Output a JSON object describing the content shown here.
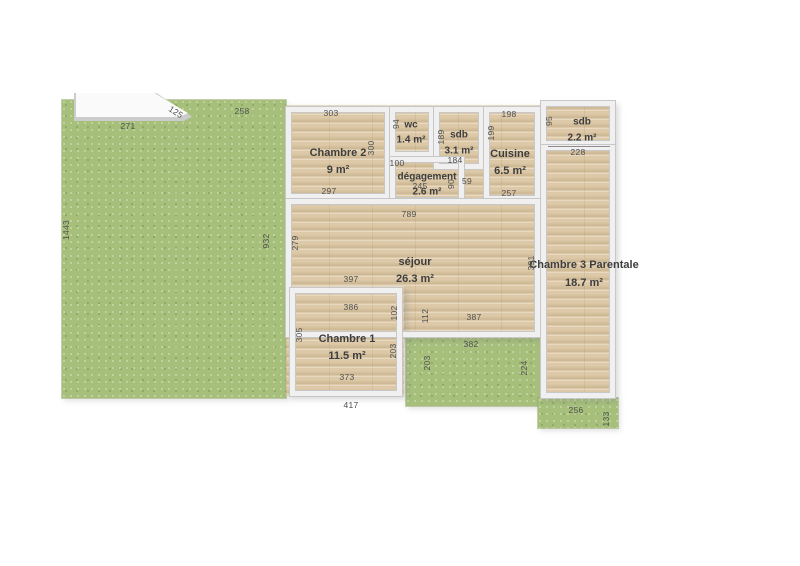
{
  "plan": {
    "colors": {
      "background": "#ffffff",
      "grass": "#a6c07c",
      "wood": "#ddc9a7",
      "wall": "#f0f0f0",
      "wall_edge": "#c7c7c7",
      "label_text": "#3d3d3d",
      "dimension_text": "#4f4f4f"
    },
    "rooms": [
      {
        "id": "chambre2",
        "name": "Chambre 2",
        "area": "9 m²",
        "box": [
          286,
          107,
          104,
          92
        ],
        "label": [
          338,
          153
        ],
        "fs": 11,
        "gap": 17
      },
      {
        "id": "wc",
        "name": "wc",
        "area": "1.4 m²",
        "box": [
          390,
          107,
          44,
          50
        ],
        "label": [
          411,
          125
        ],
        "fs": 10,
        "gap": 15
      },
      {
        "id": "sdb1",
        "name": "sdb",
        "area": "3.1 m²",
        "box": [
          434,
          107,
          50,
          62
        ],
        "label": [
          459,
          135
        ],
        "fs": 10,
        "gap": 16
      },
      {
        "id": "cuisine",
        "name": "Cuisine",
        "area": "6.5 m²",
        "box": [
          484,
          107,
          56,
          94
        ],
        "label": [
          510,
          154
        ],
        "fs": 11,
        "gap": 17
      },
      {
        "id": "degagement",
        "name": "dégagement",
        "area": "2.6 m²",
        "box": [
          390,
          157,
          74,
          46
        ],
        "label": [
          427,
          177
        ],
        "fs": 10,
        "gap": 15
      },
      {
        "id": "sdb2",
        "name": "sdb",
        "area": "2.2 m²",
        "box": [
          541,
          101,
          74,
          45
        ],
        "label": [
          582,
          122
        ],
        "fs": 10,
        "gap": 16
      },
      {
        "id": "sejour",
        "name": "séjour",
        "area": "26.3 m²",
        "box": [
          286,
          199,
          254,
          138
        ],
        "label": [
          415,
          262
        ],
        "fs": 11,
        "gap": 17
      },
      {
        "id": "chambre1",
        "name": "Chambre 1",
        "area": "11.5 m²",
        "box": [
          290,
          288,
          112,
          108
        ],
        "label": [
          347,
          339
        ],
        "fs": 11,
        "gap": 17
      },
      {
        "id": "chambre3",
        "name": "Chambre 3 Parentale",
        "area": "18.7 m²",
        "box": [
          541,
          145,
          74,
          253
        ],
        "label": [
          584,
          265
        ],
        "fs": 11,
        "gap": 18
      }
    ],
    "dimensions": [
      {
        "t": "271",
        "x": 128,
        "y": 126
      },
      {
        "t": "125",
        "x": 176,
        "y": 112,
        "o": 33
      },
      {
        "t": "258",
        "x": 242,
        "y": 111
      },
      {
        "t": "1443",
        "x": 66,
        "y": 230,
        "o": "v"
      },
      {
        "t": "932",
        "x": 266,
        "y": 241,
        "o": "v"
      },
      {
        "t": "303",
        "x": 331,
        "y": 113
      },
      {
        "t": "300",
        "x": 371,
        "y": 148,
        "o": "v"
      },
      {
        "t": "297",
        "x": 329,
        "y": 191
      },
      {
        "t": "94",
        "x": 396,
        "y": 124,
        "o": "v"
      },
      {
        "t": "189",
        "x": 441,
        "y": 137,
        "o": "v"
      },
      {
        "t": "184",
        "x": 455,
        "y": 160
      },
      {
        "t": "198",
        "x": 509,
        "y": 114
      },
      {
        "t": "199",
        "x": 491,
        "y": 133,
        "o": "v"
      },
      {
        "t": "257",
        "x": 509,
        "y": 193
      },
      {
        "t": "59",
        "x": 467,
        "y": 181
      },
      {
        "t": "100",
        "x": 397,
        "y": 163
      },
      {
        "t": "245",
        "x": 420,
        "y": 186
      },
      {
        "t": "90",
        "x": 451,
        "y": 184,
        "o": "v"
      },
      {
        "t": "95",
        "x": 549,
        "y": 121,
        "o": "v"
      },
      {
        "t": "228",
        "x": 578,
        "y": 152
      },
      {
        "t": "789",
        "x": 409,
        "y": 214
      },
      {
        "t": "279",
        "x": 295,
        "y": 243,
        "o": "v"
      },
      {
        "t": "397",
        "x": 351,
        "y": 279
      },
      {
        "t": "391",
        "x": 531,
        "y": 263,
        "o": "v"
      },
      {
        "t": "386",
        "x": 351,
        "y": 307
      },
      {
        "t": "102",
        "x": 394,
        "y": 313,
        "o": "v"
      },
      {
        "t": "112",
        "x": 425,
        "y": 316,
        "o": "v"
      },
      {
        "t": "387",
        "x": 474,
        "y": 317
      },
      {
        "t": "305",
        "x": 299,
        "y": 335,
        "o": "v"
      },
      {
        "t": "203",
        "x": 393,
        "y": 351,
        "o": "v"
      },
      {
        "t": "373",
        "x": 347,
        "y": 377
      },
      {
        "t": "417",
        "x": 351,
        "y": 405
      },
      {
        "t": "382",
        "x": 471,
        "y": 344
      },
      {
        "t": "203",
        "x": 427,
        "y": 363,
        "o": "v"
      },
      {
        "t": "224",
        "x": 524,
        "y": 368,
        "o": "v"
      },
      {
        "t": "256",
        "x": 576,
        "y": 410
      },
      {
        "t": "133",
        "x": 606,
        "y": 419,
        "o": "v"
      }
    ]
  }
}
